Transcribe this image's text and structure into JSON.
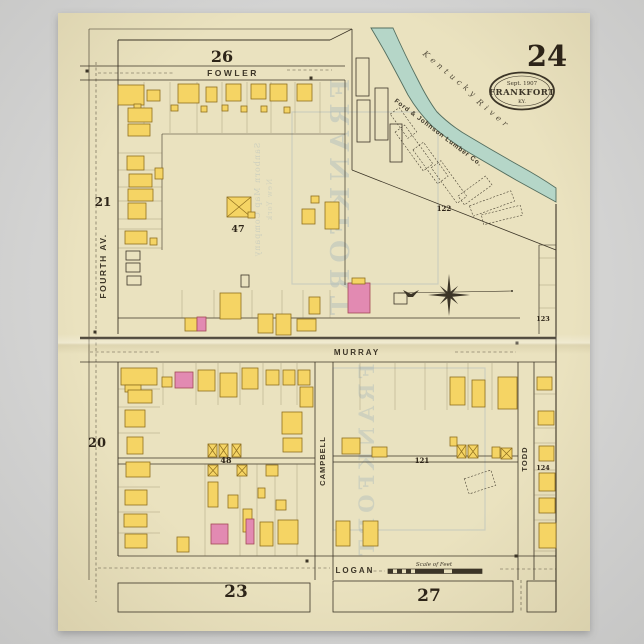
{
  "poster": {
    "page_number": "24",
    "stamp": {
      "line1": "Sept. 1907",
      "line2": "FRANKFORT",
      "line3": "KY."
    },
    "scale_label": "Scale of Feet",
    "river_label": {
      "word1": "Kentucky",
      "word2": "River"
    },
    "lumber_company": "Ford & Johnson Lumber Co.",
    "watermark": {
      "big_upper": "FRANKFORT",
      "big_lower": "FRANKFORT",
      "small1": "Sanborn Map Company",
      "small2": "New York"
    }
  },
  "colors": {
    "paper": "#eae2bf",
    "ink": "#3c3527",
    "yellow": "#f5d464",
    "yellow_stroke": "#8f6f1f",
    "pink": "#e28ab2",
    "pink_stroke": "#a34a55",
    "river": "#b5d6c8",
    "river_stroke": "#546e5f",
    "lot": "#7a6c4c",
    "ghost": "#8fa7ba"
  },
  "street_labels": [
    {
      "name": "fowler",
      "text": "FOWLER",
      "x": 233,
      "y": 76,
      "s": 8.5,
      "r": 0,
      "ls": 2.5
    },
    {
      "name": "murray",
      "text": "MURRAY",
      "x": 357,
      "y": 355,
      "s": 8,
      "r": 0,
      "ls": 2
    },
    {
      "name": "logan",
      "text": "LOGAN",
      "x": 355,
      "y": 573,
      "s": 8,
      "r": 0,
      "ls": 2
    },
    {
      "name": "fourth-av",
      "text": "FOURTH AV.",
      "x": 106,
      "y": 266,
      "s": 8.5,
      "r": -90,
      "ls": 1.5
    },
    {
      "name": "campbell",
      "text": "CAMPBELL",
      "x": 325,
      "y": 461,
      "s": 7.5,
      "r": -90,
      "ls": 1
    },
    {
      "name": "todd",
      "text": "TODD",
      "x": 527,
      "y": 459,
      "s": 7.5,
      "r": -90,
      "ls": 1
    }
  ],
  "block_numbers": [
    {
      "n": "26",
      "x": 222,
      "y": 62,
      "s": 16
    },
    {
      "n": "21",
      "x": 103,
      "y": 206,
      "s": 12
    },
    {
      "n": "47",
      "x": 238,
      "y": 232,
      "s": 9.5
    },
    {
      "n": "20",
      "x": 97,
      "y": 447,
      "s": 13
    },
    {
      "n": "48",
      "x": 226,
      "y": 463,
      "s": 8
    },
    {
      "n": "23",
      "x": 236,
      "y": 597,
      "s": 17
    },
    {
      "n": "27",
      "x": 429,
      "y": 601,
      "s": 17
    },
    {
      "n": "121",
      "x": 422,
      "y": 463,
      "s": 7
    },
    {
      "n": "122",
      "x": 444,
      "y": 211,
      "s": 7
    },
    {
      "n": "123",
      "x": 543,
      "y": 321,
      "s": 6.5
    },
    {
      "n": "124",
      "x": 543,
      "y": 470,
      "s": 6.5
    }
  ],
  "map": {
    "river_path": "M393,28 Q405,55 418,80 Q428,100 437,112 Q452,127 470,137 Q495,152 520,166 Q540,177 556,188 L556,202 Q538,192 516,180 Q492,166 468,152 Q448,140 432,126 Q418,112 408,95 Q396,72 385,52 Q377,38 371,28 Z",
    "lines": [
      [
        89,
        29,
        352,
        29,
        0.6
      ],
      [
        89,
        29,
        89,
        580,
        0.6
      ],
      [
        118,
        40,
        330,
        40,
        0.9
      ],
      [
        330,
        40,
        352,
        29,
        0.7
      ],
      [
        80,
        66,
        345,
        66,
        0.8
      ],
      [
        80,
        80,
        345,
        80,
        0.8
      ],
      [
        118,
        40,
        118,
        334,
        0.9
      ],
      [
        118,
        362,
        118,
        556,
        0.9
      ],
      [
        345,
        80,
        345,
        285,
        0.7
      ],
      [
        352,
        29,
        352,
        170,
        0.8
      ],
      [
        352,
        170,
        556,
        250,
        0.8
      ],
      [
        80,
        338,
        556,
        338,
        2.6
      ],
      [
        118,
        318,
        520,
        318,
        0.65
      ],
      [
        80,
        362,
        556,
        362,
        0.8
      ],
      [
        315,
        362,
        315,
        580,
        0.8
      ],
      [
        333,
        362,
        333,
        580,
        0.8
      ],
      [
        518,
        362,
        518,
        580,
        0.8
      ],
      [
        534,
        362,
        534,
        580,
        0.8
      ],
      [
        539,
        245,
        539,
        334,
        0.7
      ],
      [
        539,
        245,
        556,
        245,
        0.6
      ],
      [
        556,
        204,
        556,
        612,
        1.1
      ],
      [
        118,
        458,
        315,
        458,
        0.7
      ],
      [
        118,
        464,
        315,
        464,
        0.7
      ],
      [
        333,
        456,
        518,
        456,
        0.7
      ],
      [
        333,
        462,
        518,
        462,
        0.7
      ],
      [
        118,
        556,
        556,
        556,
        0.8
      ],
      [
        162,
        134,
        345,
        134,
        0.6
      ],
      [
        162,
        134,
        162,
        250,
        0.6
      ]
    ],
    "lot_lines": [
      [
        144,
        82,
        144,
        133
      ],
      [
        170,
        82,
        170,
        133
      ],
      [
        197,
        82,
        197,
        133
      ],
      [
        222,
        82,
        222,
        133
      ],
      [
        247,
        82,
        247,
        133
      ],
      [
        271,
        82,
        271,
        133
      ],
      [
        295,
        82,
        295,
        133
      ],
      [
        320,
        82,
        320,
        133
      ],
      [
        118,
        153,
        162,
        153
      ],
      [
        118,
        170,
        162,
        170
      ],
      [
        118,
        187,
        162,
        187
      ],
      [
        118,
        201,
        162,
        201
      ],
      [
        118,
        219,
        162,
        219
      ],
      [
        118,
        229,
        162,
        229
      ],
      [
        118,
        248,
        162,
        248
      ],
      [
        182,
        290,
        182,
        318
      ],
      [
        214,
        290,
        214,
        318
      ],
      [
        252,
        290,
        252,
        318
      ],
      [
        282,
        290,
        282,
        318
      ],
      [
        303,
        290,
        303,
        318
      ],
      [
        330,
        290,
        330,
        318
      ],
      [
        163,
        363,
        163,
        405
      ],
      [
        196,
        363,
        196,
        405
      ],
      [
        218,
        363,
        218,
        405
      ],
      [
        240,
        363,
        240,
        405
      ],
      [
        263,
        363,
        263,
        405
      ],
      [
        281,
        363,
        281,
        405
      ],
      [
        297,
        363,
        297,
        405
      ],
      [
        118,
        389,
        160,
        389
      ],
      [
        118,
        407,
        160,
        407
      ],
      [
        118,
        433,
        160,
        433
      ],
      [
        118,
        487,
        160,
        487
      ],
      [
        118,
        512,
        160,
        512
      ],
      [
        118,
        533,
        160,
        533
      ],
      [
        205,
        464,
        205,
        556
      ],
      [
        240,
        464,
        240,
        556
      ],
      [
        257,
        464,
        257,
        556
      ],
      [
        275,
        464,
        275,
        556
      ],
      [
        297,
        464,
        297,
        556
      ],
      [
        360,
        363,
        360,
        410
      ],
      [
        395,
        363,
        395,
        410
      ],
      [
        425,
        363,
        425,
        410
      ],
      [
        447,
        363,
        447,
        410
      ],
      [
        468,
        363,
        468,
        410
      ],
      [
        492,
        363,
        492,
        410
      ],
      [
        534,
        394,
        556,
        394
      ],
      [
        534,
        428,
        556,
        428
      ],
      [
        534,
        443,
        556,
        443
      ],
      [
        534,
        470,
        556,
        470
      ],
      [
        534,
        495,
        556,
        495
      ],
      [
        534,
        520,
        556,
        520
      ],
      [
        534,
        551,
        556,
        551
      ],
      [
        539,
        258,
        556,
        258
      ],
      [
        539,
        285,
        556,
        285
      ],
      [
        539,
        308,
        556,
        308
      ]
    ],
    "dashed_lines": [
      [
        96,
        62,
        96,
        602
      ],
      [
        98,
        73,
        175,
        73
      ],
      [
        287,
        70,
        332,
        70
      ],
      [
        90,
        352,
        160,
        352
      ],
      [
        455,
        352,
        516,
        352
      ],
      [
        98,
        568,
        330,
        568
      ],
      [
        368,
        571,
        385,
        571
      ],
      [
        500,
        569,
        556,
        569
      ],
      [
        521,
        580,
        521,
        612
      ]
    ],
    "block_rects": [
      [
        118,
        583,
        192,
        29
      ],
      [
        333,
        581,
        180,
        31
      ],
      [
        527,
        581,
        29,
        31
      ]
    ],
    "buildings": [
      [
        118,
        85,
        26,
        20,
        "y"
      ],
      [
        147,
        90,
        13,
        11,
        "y"
      ],
      [
        178,
        84,
        21,
        19,
        "y"
      ],
      [
        206,
        87,
        11,
        15,
        "y"
      ],
      [
        226,
        84,
        15,
        17,
        "y"
      ],
      [
        251,
        84,
        15,
        15,
        "y"
      ],
      [
        270,
        84,
        17,
        17,
        "y"
      ],
      [
        297,
        84,
        15,
        17,
        "y"
      ],
      [
        134,
        104,
        7,
        7,
        "y"
      ],
      [
        171,
        105,
        7,
        6,
        "y"
      ],
      [
        201,
        106,
        6,
        6,
        "y"
      ],
      [
        222,
        105,
        6,
        6,
        "y"
      ],
      [
        241,
        106,
        6,
        6,
        "y"
      ],
      [
        261,
        106,
        6,
        6,
        "y"
      ],
      [
        284,
        107,
        6,
        6,
        "y"
      ],
      [
        128,
        108,
        24,
        14,
        "y"
      ],
      [
        128,
        124,
        22,
        12,
        "y"
      ],
      [
        127,
        156,
        17,
        14,
        "y"
      ],
      [
        129,
        174,
        23,
        13,
        "y"
      ],
      [
        128,
        189,
        25,
        12,
        "y"
      ],
      [
        128,
        203,
        18,
        16,
        "y"
      ],
      [
        125,
        231,
        22,
        13,
        "y"
      ],
      [
        155,
        168,
        8,
        11,
        "y"
      ],
      [
        150,
        238,
        7,
        7,
        "y"
      ],
      [
        126,
        251,
        14,
        9,
        "o"
      ],
      [
        126,
        263,
        14,
        9,
        "o"
      ],
      [
        127,
        276,
        14,
        9,
        "o"
      ],
      [
        227,
        197,
        24,
        20,
        "x"
      ],
      [
        248,
        212,
        7,
        6,
        "y"
      ],
      [
        302,
        209,
        13,
        15,
        "y"
      ],
      [
        325,
        202,
        14,
        27,
        "y"
      ],
      [
        311,
        196,
        8,
        7,
        "y"
      ],
      [
        185,
        318,
        12,
        13,
        "y"
      ],
      [
        197,
        317,
        9,
        14,
        "p"
      ],
      [
        220,
        293,
        21,
        26,
        "y"
      ],
      [
        258,
        314,
        15,
        19,
        "y"
      ],
      [
        276,
        314,
        15,
        21,
        "y"
      ],
      [
        297,
        319,
        19,
        12,
        "y"
      ],
      [
        309,
        297,
        11,
        17,
        "y"
      ],
      [
        241,
        275,
        8,
        12,
        "o"
      ],
      [
        348,
        283,
        22,
        30,
        "p"
      ],
      [
        352,
        278,
        13,
        6,
        "y"
      ],
      [
        394,
        293,
        13,
        11,
        "o"
      ],
      [
        356,
        58,
        13,
        38,
        "o"
      ],
      [
        357,
        100,
        13,
        42,
        "o"
      ],
      [
        375,
        88,
        13,
        52,
        "o"
      ],
      [
        390,
        124,
        12,
        38,
        "o"
      ],
      [
        121,
        368,
        36,
        17,
        "y"
      ],
      [
        125,
        385,
        16,
        7,
        "y"
      ],
      [
        162,
        377,
        10,
        10,
        "y"
      ],
      [
        175,
        372,
        18,
        16,
        "p"
      ],
      [
        198,
        370,
        17,
        21,
        "y"
      ],
      [
        220,
        373,
        17,
        24,
        "y"
      ],
      [
        242,
        368,
        16,
        21,
        "y"
      ],
      [
        266,
        370,
        13,
        15,
        "y"
      ],
      [
        283,
        370,
        12,
        15,
        "y"
      ],
      [
        298,
        370,
        12,
        15,
        "y"
      ],
      [
        300,
        387,
        13,
        20,
        "y"
      ],
      [
        128,
        390,
        24,
        13,
        "y"
      ],
      [
        125,
        410,
        20,
        17,
        "y"
      ],
      [
        127,
        437,
        16,
        17,
        "y"
      ],
      [
        126,
        462,
        24,
        15,
        "y"
      ],
      [
        125,
        490,
        22,
        15,
        "y"
      ],
      [
        124,
        514,
        23,
        13,
        "y"
      ],
      [
        125,
        534,
        22,
        14,
        "y"
      ],
      [
        177,
        537,
        12,
        15,
        "y"
      ],
      [
        282,
        412,
        20,
        22,
        "y"
      ],
      [
        283,
        438,
        19,
        14,
        "y"
      ],
      [
        208,
        444,
        9,
        13,
        "x"
      ],
      [
        219,
        444,
        9,
        13,
        "x"
      ],
      [
        232,
        444,
        9,
        13,
        "x"
      ],
      [
        208,
        465,
        10,
        11,
        "x"
      ],
      [
        237,
        465,
        10,
        11,
        "x"
      ],
      [
        266,
        465,
        12,
        11,
        "y"
      ],
      [
        208,
        482,
        10,
        25,
        "y"
      ],
      [
        228,
        495,
        10,
        13,
        "y"
      ],
      [
        243,
        509,
        9,
        23,
        "y"
      ],
      [
        246,
        519,
        8,
        25,
        "p"
      ],
      [
        211,
        524,
        17,
        20,
        "p"
      ],
      [
        260,
        522,
        13,
        24,
        "y"
      ],
      [
        278,
        520,
        20,
        24,
        "y"
      ],
      [
        258,
        488,
        7,
        10,
        "y"
      ],
      [
        276,
        500,
        10,
        10,
        "y"
      ],
      [
        336,
        521,
        14,
        25,
        "y"
      ],
      [
        363,
        521,
        15,
        25,
        "y"
      ],
      [
        450,
        377,
        15,
        28,
        "y"
      ],
      [
        472,
        380,
        13,
        27,
        "y"
      ],
      [
        498,
        377,
        19,
        32,
        "y"
      ],
      [
        342,
        438,
        18,
        16,
        "y"
      ],
      [
        372,
        447,
        15,
        10,
        "y"
      ],
      [
        450,
        437,
        7,
        9,
        "y"
      ],
      [
        457,
        445,
        9,
        13,
        "x"
      ],
      [
        468,
        445,
        10,
        13,
        "x"
      ],
      [
        492,
        447,
        8,
        11,
        "y"
      ],
      [
        501,
        448,
        11,
        11,
        "x"
      ],
      [
        537,
        377,
        15,
        13,
        "y"
      ],
      [
        538,
        411,
        16,
        14,
        "y"
      ],
      [
        539,
        446,
        15,
        15,
        "y"
      ],
      [
        539,
        473,
        16,
        18,
        "y"
      ],
      [
        539,
        498,
        16,
        15,
        "y"
      ],
      [
        539,
        523,
        17,
        25,
        "y"
      ]
    ],
    "sheds": [
      [
        398,
        108,
        11,
        30,
        -36
      ],
      [
        408,
        124,
        12,
        48,
        -36
      ],
      [
        424,
        142,
        13,
        42,
        -36
      ],
      [
        443,
        160,
        12,
        44,
        -36
      ],
      [
        458,
        185,
        34,
        11,
        -36
      ],
      [
        470,
        198,
        44,
        11,
        -20
      ],
      [
        482,
        210,
        40,
        10,
        -14
      ],
      [
        466,
        474,
        28,
        16,
        -18
      ]
    ],
    "dots": [
      [
        87,
        71
      ],
      [
        311,
        78
      ],
      [
        95,
        332
      ],
      [
        517,
        343
      ],
      [
        307,
        561
      ],
      [
        516,
        556
      ]
    ],
    "ghost_rects": [
      [
        292,
        112,
        146,
        172
      ],
      [
        333,
        368,
        152,
        162
      ]
    ]
  }
}
